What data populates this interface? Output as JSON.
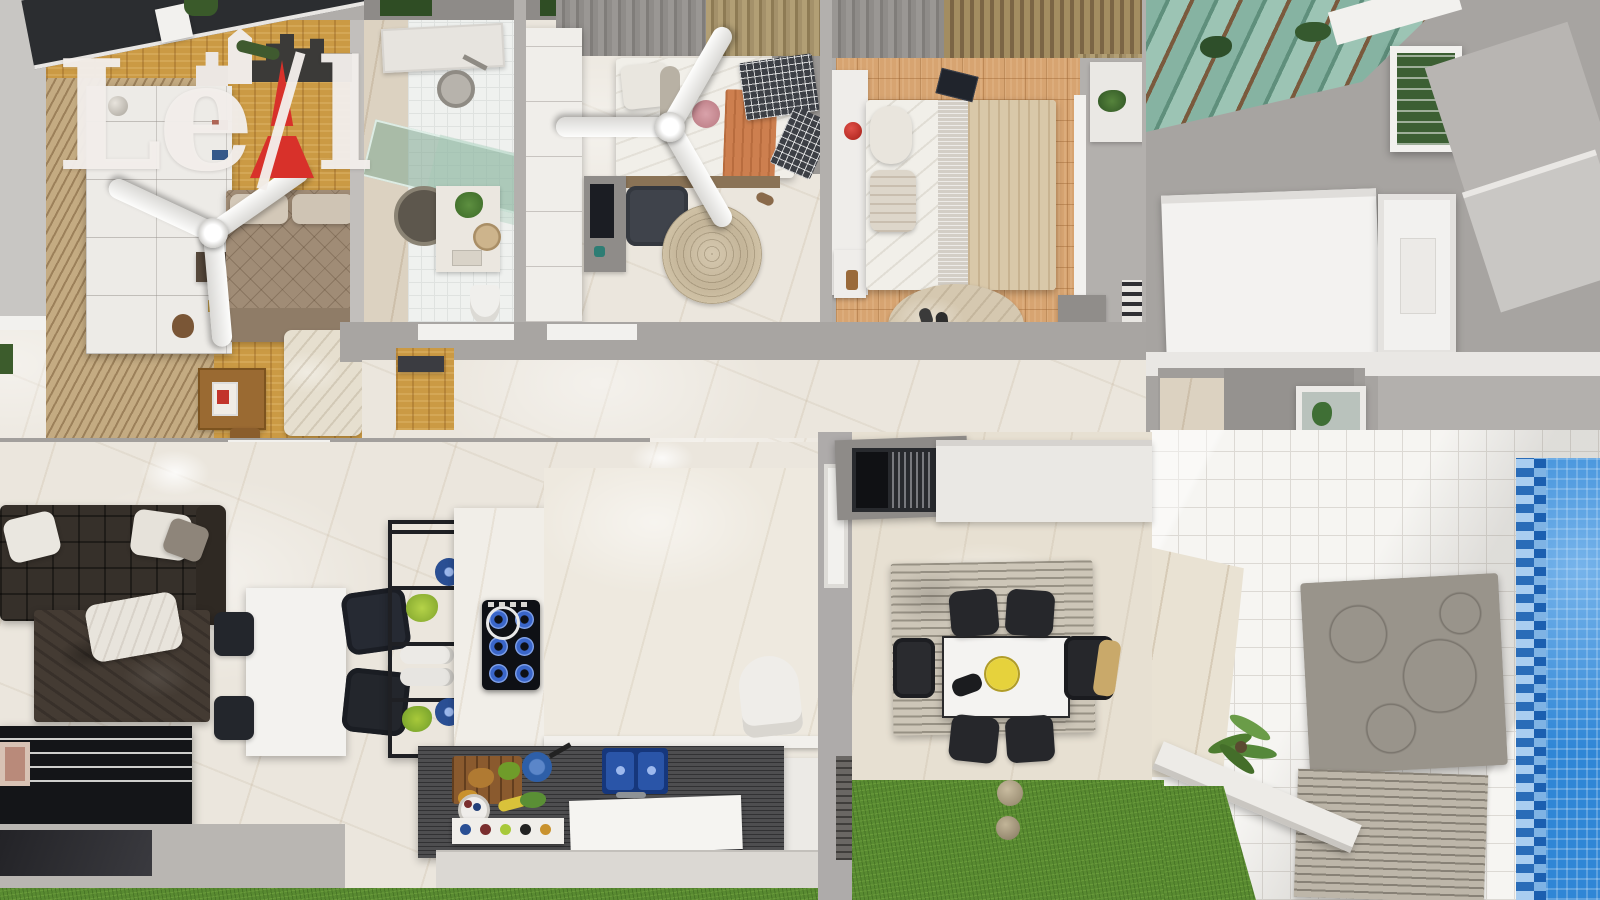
{
  "scene": {
    "type": "photorealistic top-down 3D floor plan render of a single-storey house",
    "view": "top-down dollhouse",
    "areas": [
      "bedroom-with-deck-slats-and-ceiling-fan",
      "bathroom-with-glass-shower",
      "bedroom-with-ceiling-fan-and-desk",
      "master-bedroom-terracotta-floor",
      "hallway",
      "living-room-dark-sofa",
      "kitchen-island-and-blue-cooktop",
      "indoor-dining-table",
      "outdoor-gourmet-counter",
      "outdoor-dining-patio",
      "backyard-lawn",
      "service-room",
      "side-tiled-patio",
      "swimming-pool"
    ]
  },
  "watermark": {
    "text": "LeAl",
    "part_le": "Le",
    "part_l": "l",
    "tower_letter_represented": "A",
    "text_color": "#f3eeeb",
    "accent_color": "#d8312a"
  },
  "palette": {
    "marble_floor": "#ebe6dd",
    "wood_floor": "#cb9a44",
    "deck_slats": "#c4ab82",
    "terracotta_parquet": "#d7a471",
    "roof_dark": "#2b2d30",
    "wall_gray": "#a8a5a2",
    "white_surface": "#f2f1ee",
    "sofa_dark": "#36302a",
    "grass_green": "#598b31",
    "pool_water": "#2f86d6",
    "counter_dark": "#4a4a4c",
    "sink_blue": "#2a55a8",
    "burner_blue": "#3a66c9",
    "curtain_gray": "#8f8c89",
    "curtain_tan": "#a4916a",
    "rug_cream": "#e6dfcf",
    "rug_jute": "#c4b599",
    "plant_green": "#9cbf3a"
  }
}
